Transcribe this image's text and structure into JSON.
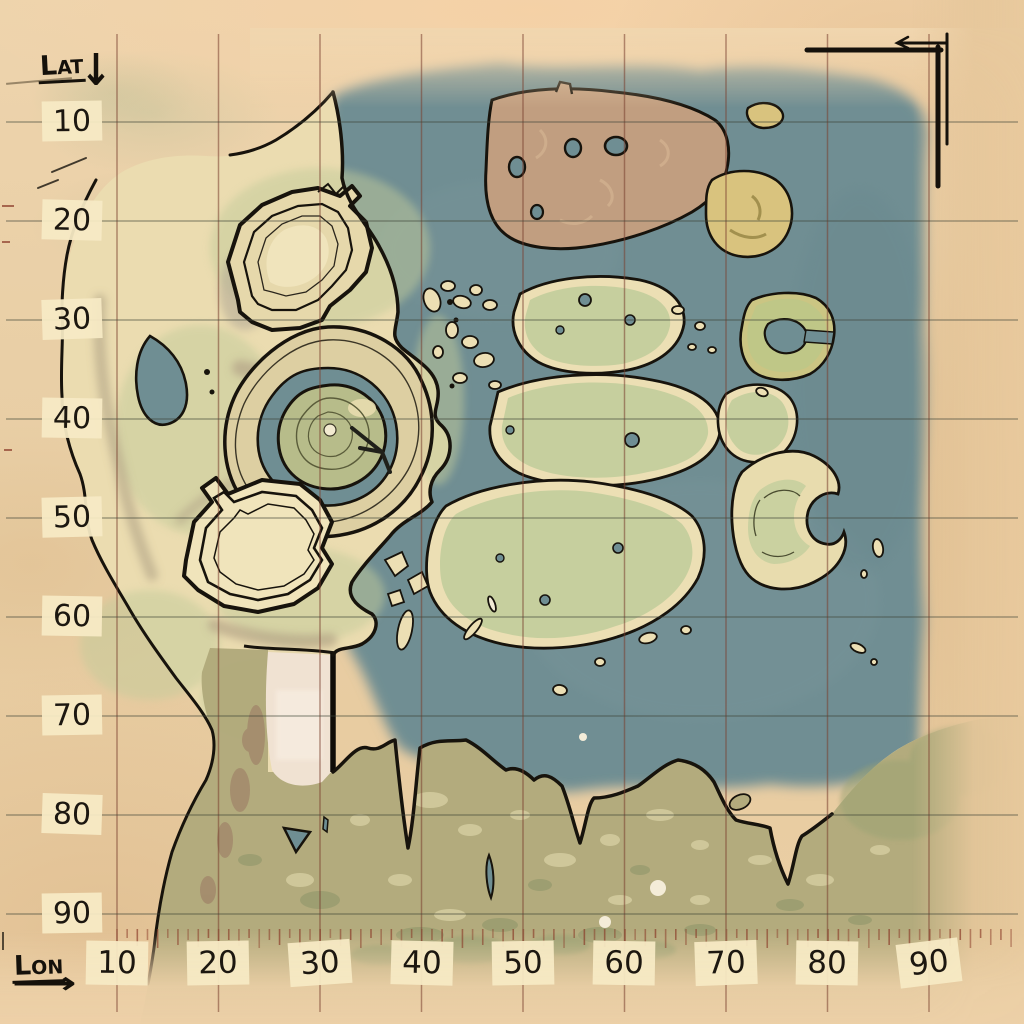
{
  "map": {
    "title": "hand-drawn parchment survival map with lat/lon grid",
    "kind": "topographic game map"
  },
  "axes": {
    "lat": {
      "label": "Lat",
      "arrow": "↓",
      "arrow_icon": "down-arrow",
      "values": [
        "10",
        "20",
        "30",
        "40",
        "50",
        "60",
        "70",
        "80",
        "90"
      ]
    },
    "lon": {
      "label": "Lon",
      "arrow": "⟶",
      "arrow_icon": "right-arrow",
      "values": [
        "10",
        "20",
        "30",
        "40",
        "50",
        "60",
        "70",
        "80",
        "90"
      ]
    }
  },
  "icons": {
    "corner_bracket": "ne-corner-bracket"
  },
  "colors": {
    "paper": "#e9cfa6",
    "water": "#6f8e93",
    "land_cream": "#ebdcb0",
    "land_green": "#c6cf9e",
    "land_olive": "#b1a97b",
    "island_brown": "#c19e80",
    "island_yellow": "#d9c37e",
    "outline": "#17130c",
    "grid_vertical": "#7a4030",
    "grid_horizontal": "#41463a",
    "tick": "#8a3a28",
    "label_chip": "#f6eac5"
  }
}
